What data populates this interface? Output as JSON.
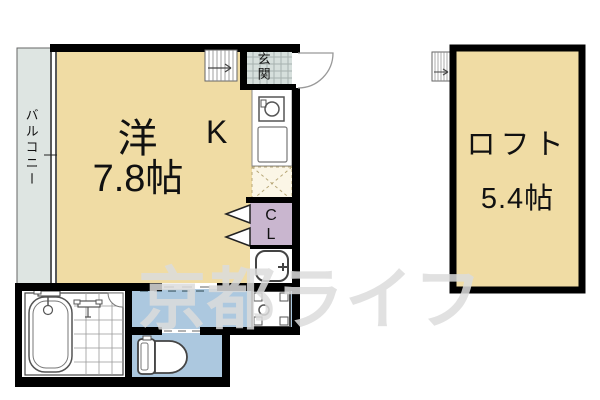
{
  "floorplan": {
    "main_room": {
      "name": "洋",
      "size": "7.8帖"
    },
    "kitchen": {
      "label": "K"
    },
    "entrance": {
      "label": "玄関"
    },
    "closet": {
      "line1": "C",
      "line2": "L"
    },
    "balcony": {
      "label": "バルコニー"
    },
    "loft": {
      "name": "ロフト",
      "size": "5.4帖"
    },
    "watermark": "京都ライフ",
    "colors": {
      "room_tan": "#F0DCA4",
      "closet_purple": "#C9B6CF",
      "wet_blue": "#ACC8DF",
      "balcony_gray": "#DEE5E2",
      "entrance_tile": "#D6DFDC",
      "tile_grid": "#A7B2AF",
      "wall": "#000000",
      "fixture_line": "#555555"
    }
  }
}
